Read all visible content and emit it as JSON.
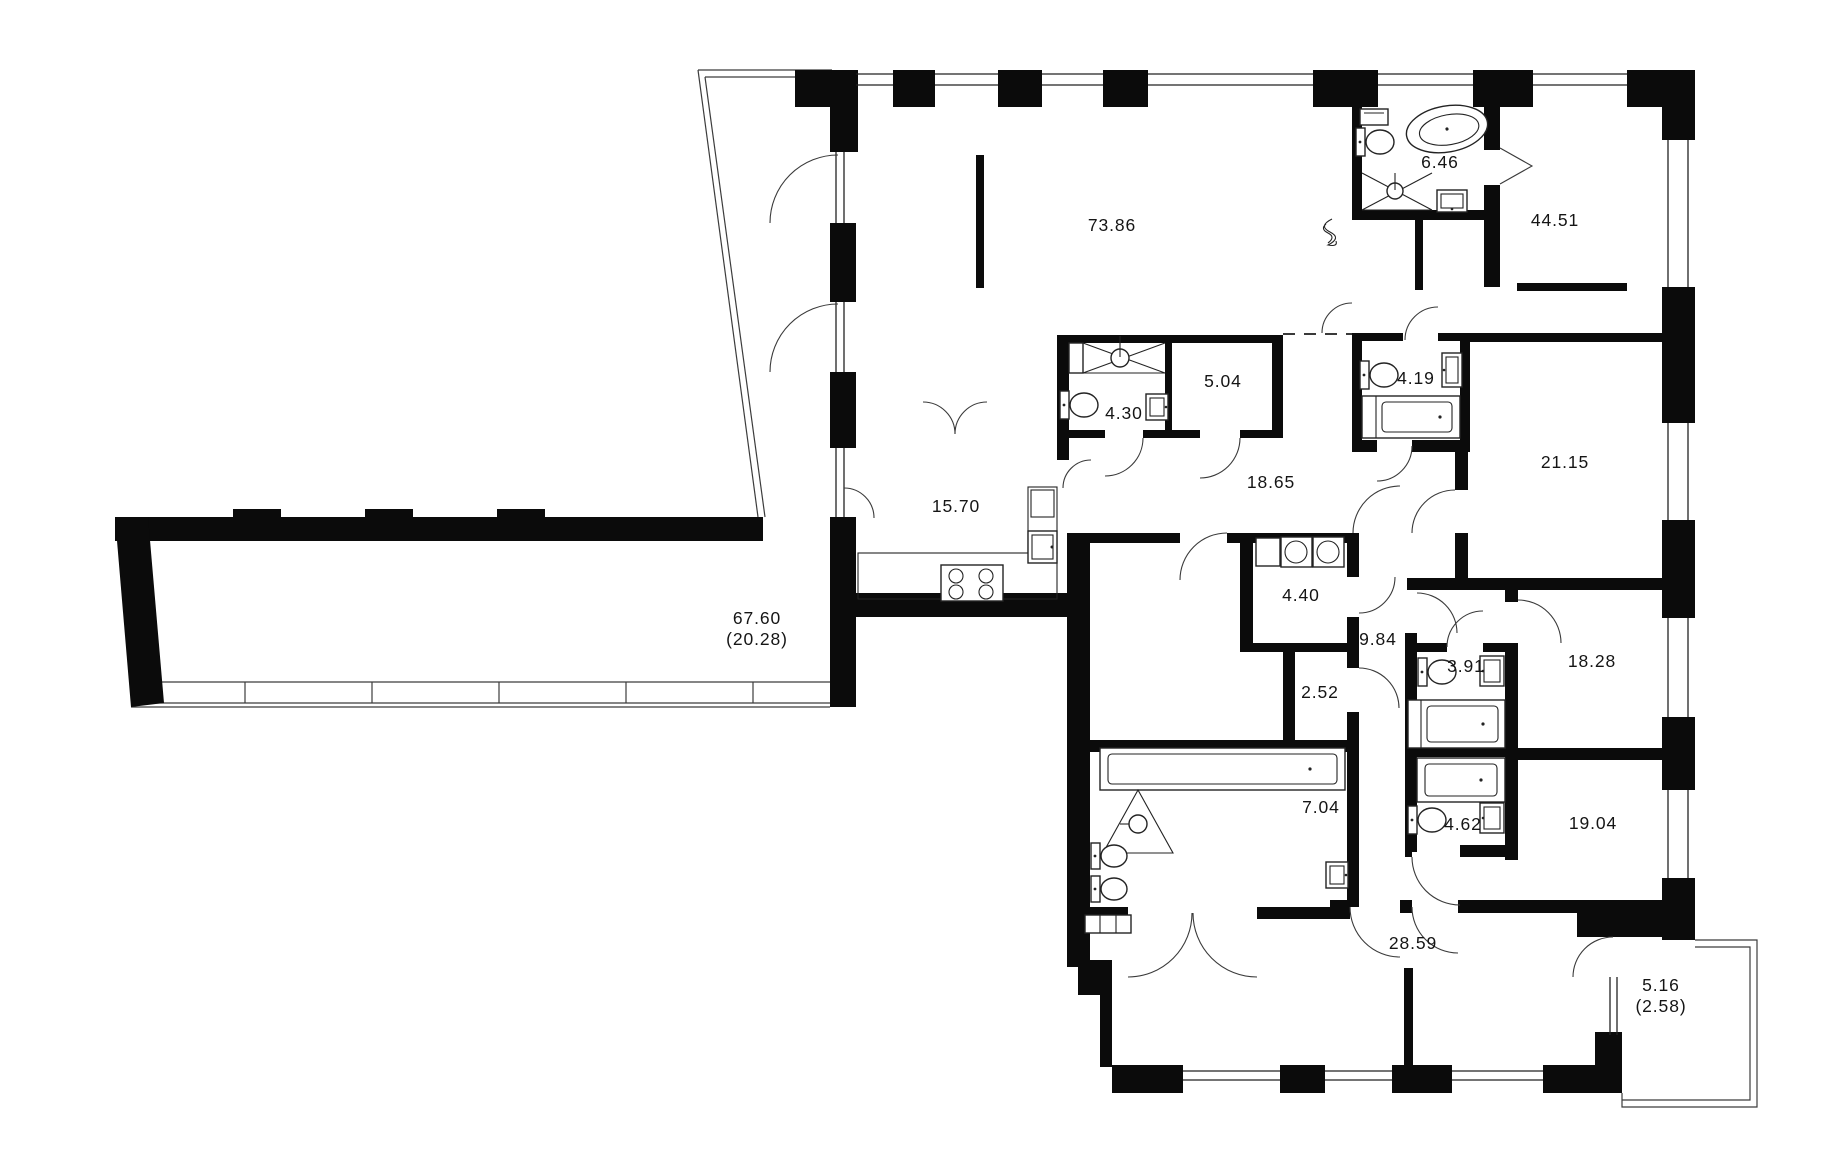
{
  "plan": {
    "title": "apartment-floor-plan",
    "colors": {
      "walls": "#0b0b0b",
      "lines": "#3c3c3c",
      "background": "#ffffff",
      "text": "#151515"
    },
    "fixtures": [
      "bathtub-icon",
      "oval-bathtub-icon",
      "toilet-icon",
      "sink-icon",
      "shower-icon",
      "washer-icon",
      "stove-icon",
      "towel-radiator-icon",
      "kitchen-counter",
      "railing"
    ],
    "rooms": [
      {
        "id": "living-room",
        "area": "73.86",
        "x": 1112,
        "y": 231
      },
      {
        "id": "bathroom-top",
        "area": "6.46",
        "x": 1440,
        "y": 168
      },
      {
        "id": "bedroom-ne",
        "area": "44.51",
        "x": 1555,
        "y": 226
      },
      {
        "id": "shower-room",
        "area": "4.30",
        "x": 1124,
        "y": 419
      },
      {
        "id": "storage",
        "area": "5.04",
        "x": 1223,
        "y": 387
      },
      {
        "id": "bathroom-419",
        "area": "4.19",
        "x": 1416,
        "y": 384
      },
      {
        "id": "kitchen",
        "area": "15.70",
        "x": 956,
        "y": 512
      },
      {
        "id": "hallway",
        "area": "18.65",
        "x": 1271,
        "y": 488
      },
      {
        "id": "terrace",
        "area": "67.60",
        "area_secondary": "(20.28)",
        "x": 757,
        "y": 624
      },
      {
        "id": "bedroom-e",
        "area": "21.15",
        "x": 1565,
        "y": 468
      },
      {
        "id": "laundry",
        "area": "4.40",
        "x": 1301,
        "y": 601
      },
      {
        "id": "corridor",
        "area": "9.84",
        "x": 1378,
        "y": 645
      },
      {
        "id": "closet",
        "area": "2.52",
        "x": 1320,
        "y": 698
      },
      {
        "id": "bathroom-391",
        "area": "3.91",
        "x": 1466,
        "y": 672
      },
      {
        "id": "bedroom-se1",
        "area": "18.28",
        "x": 1592,
        "y": 667
      },
      {
        "id": "bathroom-704",
        "area": "7.04",
        "x": 1321,
        "y": 813
      },
      {
        "id": "bathroom-462",
        "area": "4.62",
        "x": 1463,
        "y": 830
      },
      {
        "id": "bedroom-se2",
        "area": "19.04",
        "x": 1593,
        "y": 829
      },
      {
        "id": "hall-lower",
        "area": "28.59",
        "x": 1413,
        "y": 949
      },
      {
        "id": "balcony",
        "area": "5.16",
        "area_secondary": "(2.58)",
        "x": 1661,
        "y": 991
      }
    ]
  }
}
